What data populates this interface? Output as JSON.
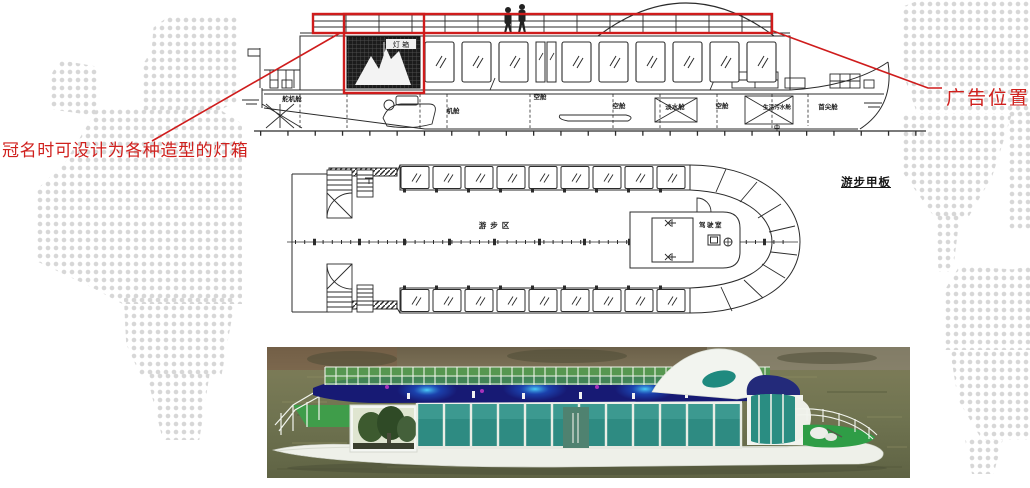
{
  "annotations": {
    "left_callout": "冠名时可设计为各种造型的灯箱",
    "right_callout": "广告位置",
    "annotation_red": "#d0201d"
  },
  "side_view": {
    "lightbox_label": "灯 箱",
    "compartments": [
      "舵机舱",
      "机舱",
      "空舱",
      "空舱",
      "淡水舱",
      "空舱",
      "生活污水舱",
      "首尖舱"
    ],
    "center_mark": "中"
  },
  "deck_plan": {
    "area_label": "游步区",
    "wheelhouse_label": "驾驶室",
    "deck_label": "游步甲板"
  },
  "colors": {
    "drawing_line": "#2b2b2b",
    "map_dots": "#d7d7d7",
    "photo_water": "#75754f",
    "photo_hull_white": "#eef0e9",
    "photo_glass_teal": "#2e8b82",
    "photo_led_navy": "#181c74",
    "photo_railing_green": "#4d9f4f",
    "photo_deck_green": "#2f9d46"
  }
}
